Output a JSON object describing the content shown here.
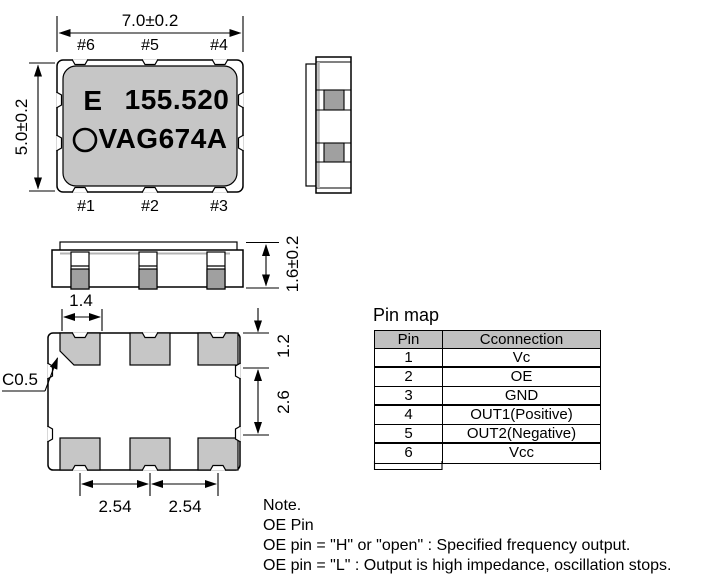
{
  "package": {
    "marking": {
      "grade": "E",
      "frequency": "155.520",
      "model": "VAG674A"
    },
    "pins_top": [
      "#6",
      "#5",
      "#4"
    ],
    "pins_bottom": [
      "#1",
      "#2",
      "#3"
    ]
  },
  "dimensions": {
    "body_width": "7.0±0.2",
    "body_height": "5.0±0.2",
    "thickness": "1.6±0.2",
    "pad_width": "1.4",
    "pad_height": "1.2",
    "row_gap": "2.6",
    "pitch_left": "2.54",
    "pitch_right": "2.54",
    "chamfer": "C0.5"
  },
  "pin_map": {
    "title": "Pin map",
    "headers": {
      "pin": "Pin",
      "connection": "Cconnection"
    },
    "rows": [
      {
        "pin": "1",
        "connection": "Vc"
      },
      {
        "pin": "2",
        "connection": "OE"
      },
      {
        "pin": "3",
        "connection": "GND"
      },
      {
        "pin": "4",
        "connection": "OUT1(Positive)"
      },
      {
        "pin": "5",
        "connection": "OUT2(Negative)"
      },
      {
        "pin": "6",
        "connection": "Vcc"
      }
    ]
  },
  "notes": {
    "title": "Note.",
    "subtitle": "OE Pin",
    "line1": "OE pin = \"H\" or \"open\" : Specified frequency output.",
    "line2": "OE pin = \"L\" : Output is high impedance, oscillation stops."
  },
  "colors": {
    "body_gray": "#c6c6c6",
    "pad_gray": "#a0a0a0",
    "lid_gray": "#b4b4b4",
    "table_header_gray": "#c0c0c0",
    "line_black": "#000000"
  }
}
